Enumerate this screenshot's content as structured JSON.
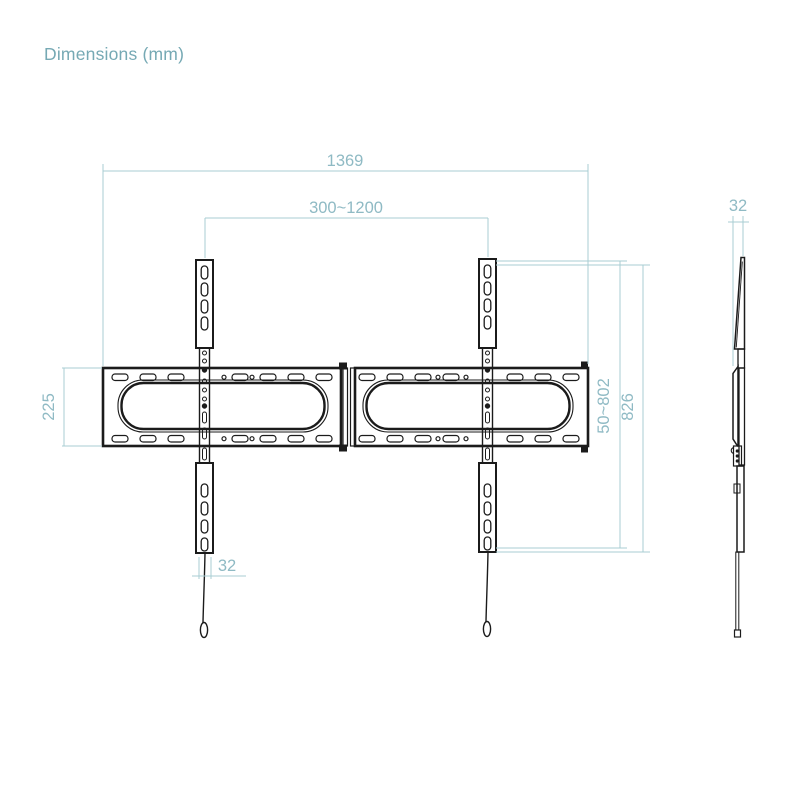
{
  "title": "Dimensions (mm)",
  "colors": {
    "dimension_line": "#a9cdd3",
    "dimension_text": "#8fbac4",
    "drawing_line": "#1b1b1b",
    "title_text": "#76a9b4",
    "background": "#ffffff"
  },
  "front_view": {
    "overall_width": "1369",
    "vesa_width_range": "300~1200",
    "wall_plate_height": "225",
    "vesa_height_range": "50~802",
    "bracket_height": "826",
    "arm_width": "32"
  },
  "side_view": {
    "depth": "32"
  }
}
